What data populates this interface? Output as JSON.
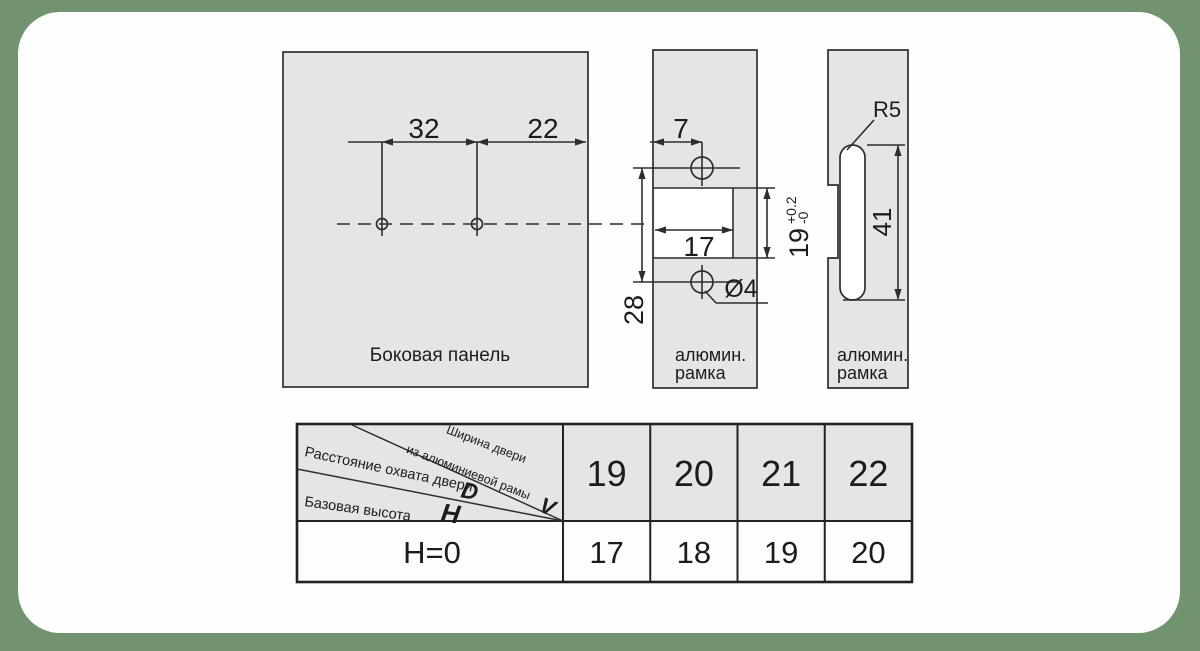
{
  "colors": {
    "background_green": "#719370",
    "card_white": "#fdfdfd",
    "panel_gray": "#e4e6e4",
    "line_dark": "#2e2e2e",
    "text_dark": "#1c1c1c"
  },
  "views": {
    "side_panel": {
      "name": "Боковая панель",
      "dims": {
        "d32": "32",
        "d22": "22"
      }
    },
    "frame_front": {
      "name_line1": "алюмин.",
      "name_line2": "рамка",
      "dims": {
        "d7": "7",
        "d17": "17",
        "d28": "28",
        "d19": "19",
        "d19_tol_plus": "+0.2",
        "d19_tol_minus": "-0",
        "hole_dia": "Ø4"
      }
    },
    "frame_side": {
      "name_line1": "алюмин.",
      "name_line2": "рамка",
      "dims": {
        "radius": "R5",
        "d41": "41"
      }
    }
  },
  "table": {
    "header": {
      "v_line1": "Ширина двери",
      "v_line2": "из алюминиевой рамы",
      "v_letter": "V",
      "d_label": "Расстояние охвата двери",
      "d_letter": "D",
      "h_label": "Базовая высота",
      "h_letter": "H"
    },
    "col_headers": [
      "19",
      "20",
      "21",
      "22"
    ],
    "rows": [
      {
        "label": "H=0",
        "values": [
          "17",
          "18",
          "19",
          "20"
        ]
      }
    ]
  }
}
